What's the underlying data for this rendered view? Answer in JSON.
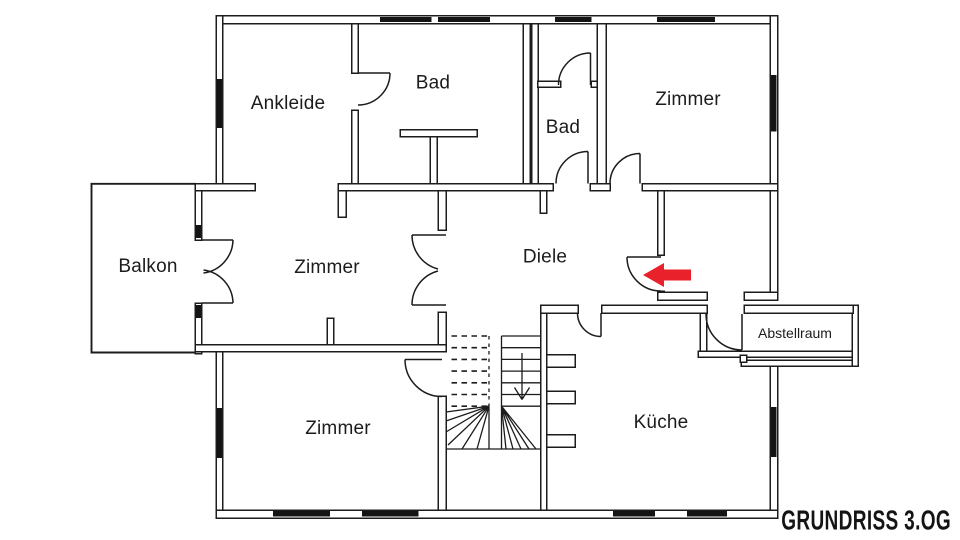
{
  "title": "GRUNDRISS 3.OG",
  "rooms": [
    {
      "id": "ankleide",
      "label": "Ankleide"
    },
    {
      "id": "bad-top",
      "label": "Bad"
    },
    {
      "id": "bad-small",
      "label": "Bad"
    },
    {
      "id": "zimmer-top-right",
      "label": "Zimmer"
    },
    {
      "id": "balkon",
      "label": "Balkon"
    },
    {
      "id": "zimmer-middle",
      "label": "Zimmer"
    },
    {
      "id": "diele",
      "label": "Diele"
    },
    {
      "id": "zimmer-bottom",
      "label": "Zimmer"
    },
    {
      "id": "kueche",
      "label": "Küche"
    },
    {
      "id": "abstellraum",
      "label": "Abstellraum"
    }
  ],
  "annotations": {
    "entrance_arrow_direction": "left",
    "stairs_direction": "down"
  },
  "colors": {
    "background": "#ffffff",
    "wall_line": "#1c1c1c",
    "window_fill": "#141414",
    "entrance_arrow": "#e8212a",
    "title_text": "#141414"
  }
}
